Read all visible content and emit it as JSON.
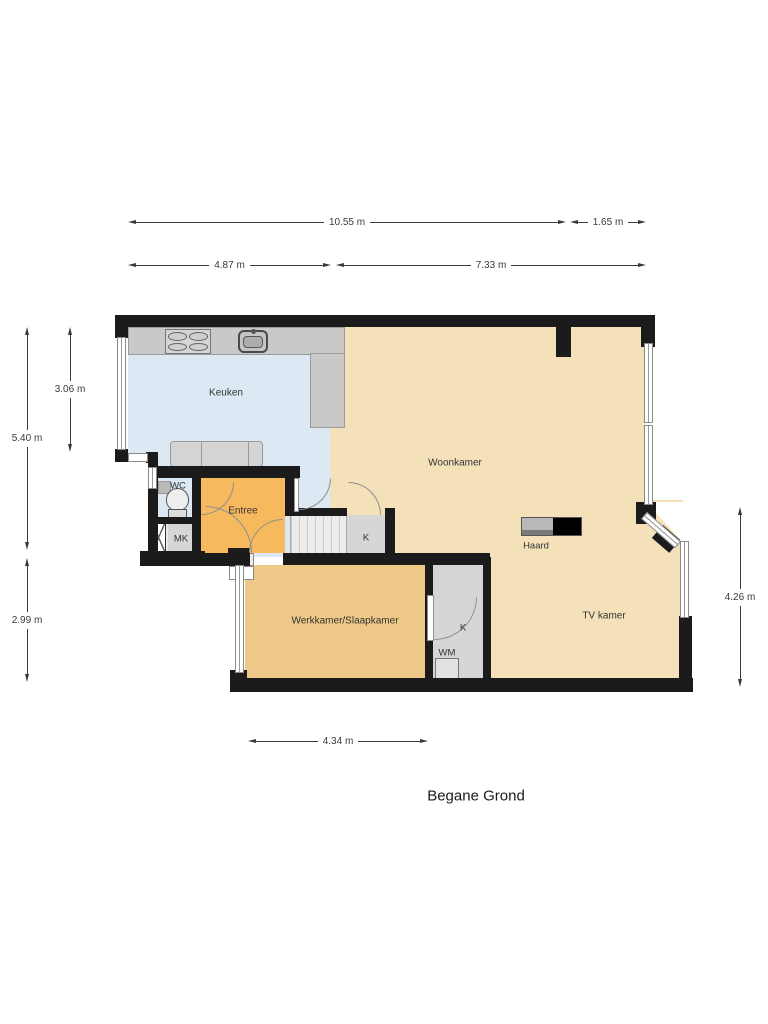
{
  "title": "Begane Grond",
  "rooms": {
    "keuken": "Keuken",
    "woonkamer": "Woonkamer",
    "entree": "Entree",
    "wc": "WC",
    "mk": "MK",
    "kast_boven": "K",
    "kast_onder": "K",
    "wm": "WM",
    "haard": "Haard",
    "werkkamer": "Werkkamer/Slaapkamer",
    "tv_kamer": "TV kamer"
  },
  "dimensions": {
    "top_total": "10.55 m",
    "top_bay": "1.65 m",
    "upper_left": "4.87 m",
    "upper_right": "7.33 m",
    "left_total": "5.40 m",
    "left_kitchen": "3.06 m",
    "left_lower": "2.99 m",
    "right_lower": "4.26 m",
    "bottom": "4.34 m"
  },
  "colors": {
    "wall": "#1b1b1b",
    "kitchen": "#dce8f3",
    "living": "#f4e1b9",
    "entree": "#f7b95d",
    "work": "#edc886",
    "closet": "#d6d6d6",
    "counter": "#c9c9c9",
    "dim": "#3a3a3a",
    "text": "#333333",
    "door": "#8f8f8f",
    "window_frame": "#8a8a8a"
  }
}
